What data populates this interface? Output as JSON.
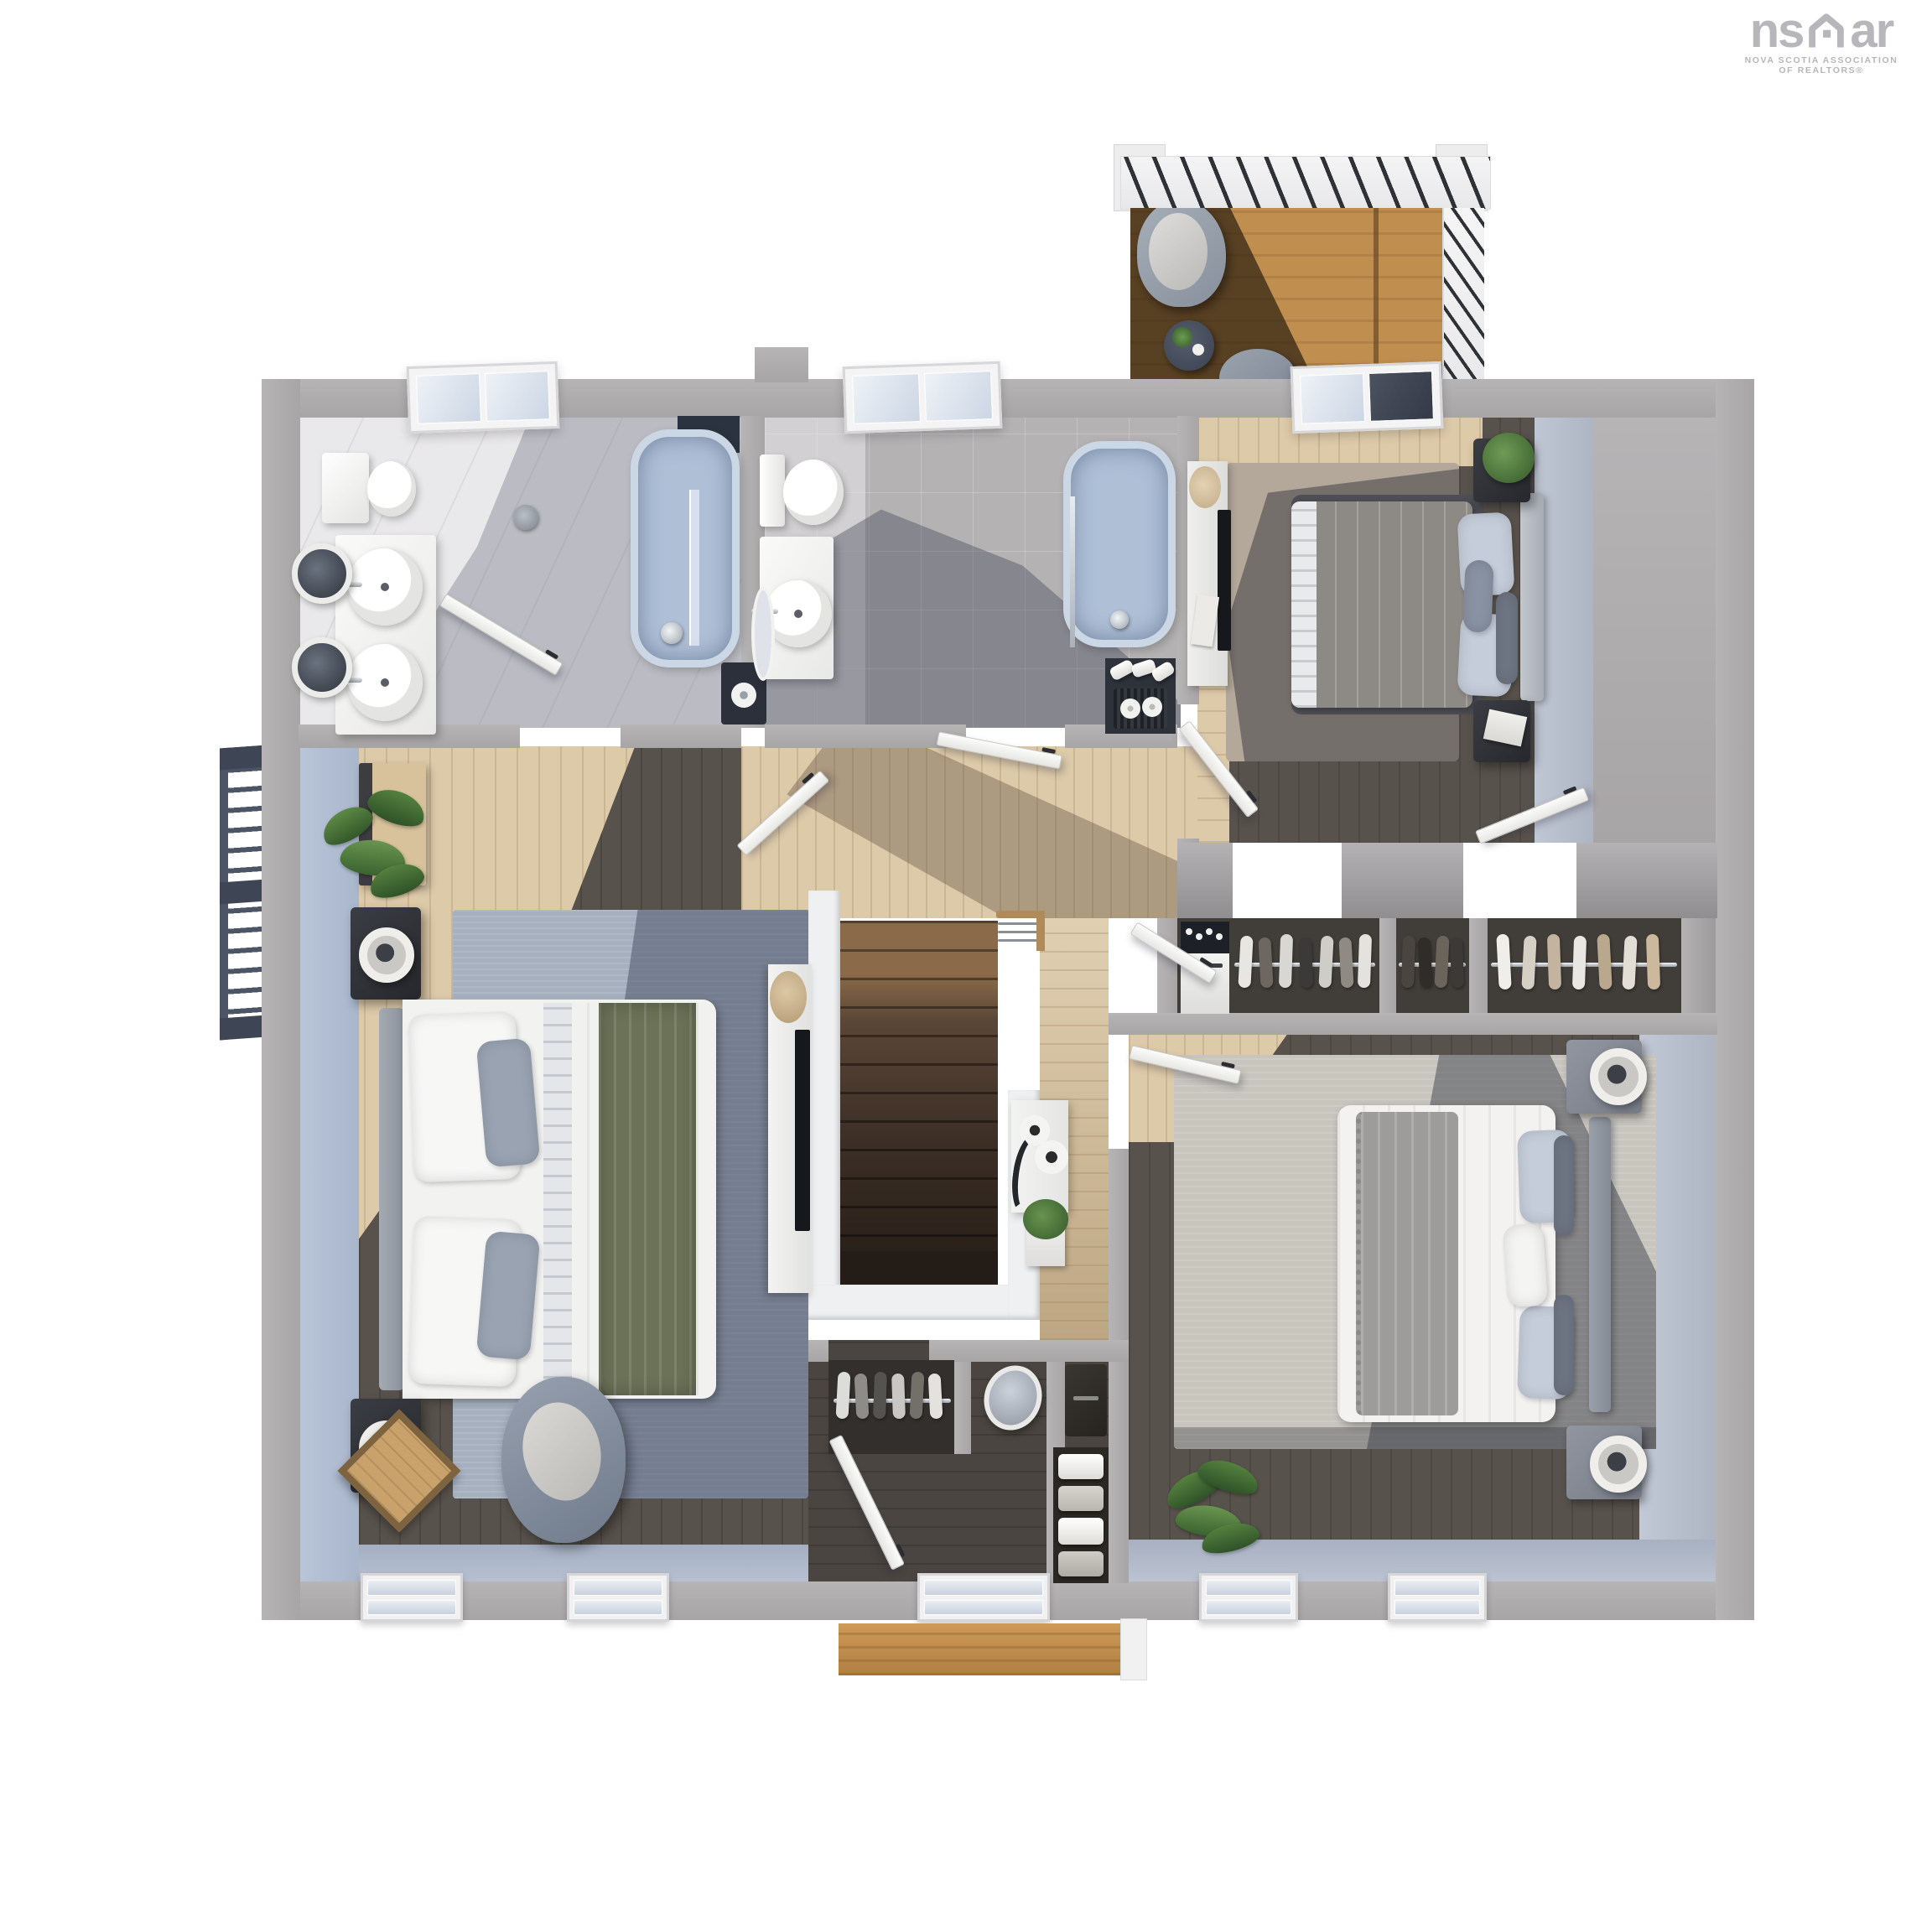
{
  "logo": {
    "brand_pre": "ns",
    "brand_post": "ar",
    "line1": "NOVA SCOTIA ASSOCIATION",
    "line2": "OF REALTORS®"
  },
  "colors": {
    "wall": "#a8a5a6",
    "wallLight": "#b6b4b5",
    "wallFace": "#b4b2b3",
    "white": "#f2f2f1",
    "blueWall": "#b9c5d8",
    "faceBlue": "#c2c9d6",
    "floorLight": "#ddcaa9",
    "floorShadow": "#b49f85",
    "floorDark": "#58524c",
    "floorDarker": "#45403b",
    "bath1Floor": "#e9e8ea",
    "bath2Floor": "#b4b2b3",
    "tub": "#aebfd6",
    "glass": "#dfe6ee",
    "rugBlue": "#a6b0bf",
    "rugBlueDark": "#6d7689",
    "rugTaupe": "#b3a89a",
    "rugDark": "#56575d",
    "rugLight": "#c8c5bf",
    "duvetGray": "#8d8a85",
    "throwGreen": "#6b7257",
    "throwGray": "#9d9c9a",
    "pillowBlue": "#c5cdda",
    "pillowDark": "#6f7684",
    "stairLight": "#8a6a49",
    "stairMid": "#5a4636",
    "stairDark": "#3c2f26",
    "deck": "#c08f50",
    "deckShadow": "#2f2112",
    "railing": "#4c5566",
    "chrome": "#c9ced4",
    "black": "#17181c",
    "plant": "#4e7a3c",
    "plantDark": "#2f5228",
    "logoGray": "#b7b6ba"
  },
  "floorplan": {
    "view": "3d-top-down-render",
    "rooms": [
      {
        "name": "ensuite-bathroom",
        "features": [
          "toilet",
          "double-sink-vanity",
          "two-round-mirrors",
          "bathtub",
          "glass-shower",
          "shower-head",
          "skylight",
          "toilet-paper-shelf"
        ]
      },
      {
        "name": "main-bathroom",
        "features": [
          "toilet",
          "single-sink-vanity",
          "leaning-mirror",
          "bathtub",
          "shower-rail",
          "skylight",
          "linen-nook-with-towels"
        ]
      },
      {
        "name": "bedroom-top-right",
        "features": [
          "double-bed-gray-duvet",
          "blue-pillows",
          "headboard",
          "two-nightstands",
          "potted-plant",
          "book",
          "area-rug",
          "dresser-with-tv",
          "skylight",
          "closet-door"
        ]
      },
      {
        "name": "closet-band",
        "features": [
          "stacked-laundry-unit",
          "three-closet-compartments",
          "hanging-clothes",
          "chrome-rails"
        ]
      },
      {
        "name": "bedroom-bottom-right",
        "features": [
          "double-bed-white-duvet",
          "gray-fringed-throw",
          "two-nightstands-with-drum-lamps",
          "area-rug",
          "palm-plant",
          "two-windows"
        ]
      },
      {
        "name": "primary-bedroom",
        "features": [
          "double-bed-white-duvet",
          "green-throw",
          "two-nightstands-with-lamps",
          "dresser-with-plant",
          "swivel-armchair",
          "diamond-side-table",
          "blue-accent-wall",
          "area-rug",
          "tv-console",
          "two-windows"
        ]
      },
      {
        "name": "hallway",
        "features": [
          "dark-wood-staircase",
          "wood-cable-railing",
          "console-with-jars",
          "planter",
          "open-doors"
        ]
      },
      {
        "name": "landing-closet",
        "features": [
          "hanging-clothes-rail",
          "oval-mirror",
          "dark-dresser",
          "folded-clothes-shelves",
          "window"
        ]
      },
      {
        "name": "balcony",
        "features": [
          "pergola-beams",
          "wood-deck",
          "lounge-chair",
          "side-table-with-plant",
          "second-chair",
          "cable-railing"
        ]
      },
      {
        "name": "exterior",
        "features": [
          "fire-escape-stair",
          "porch-roof",
          "bottom-windows",
          "skylights"
        ]
      }
    ]
  }
}
